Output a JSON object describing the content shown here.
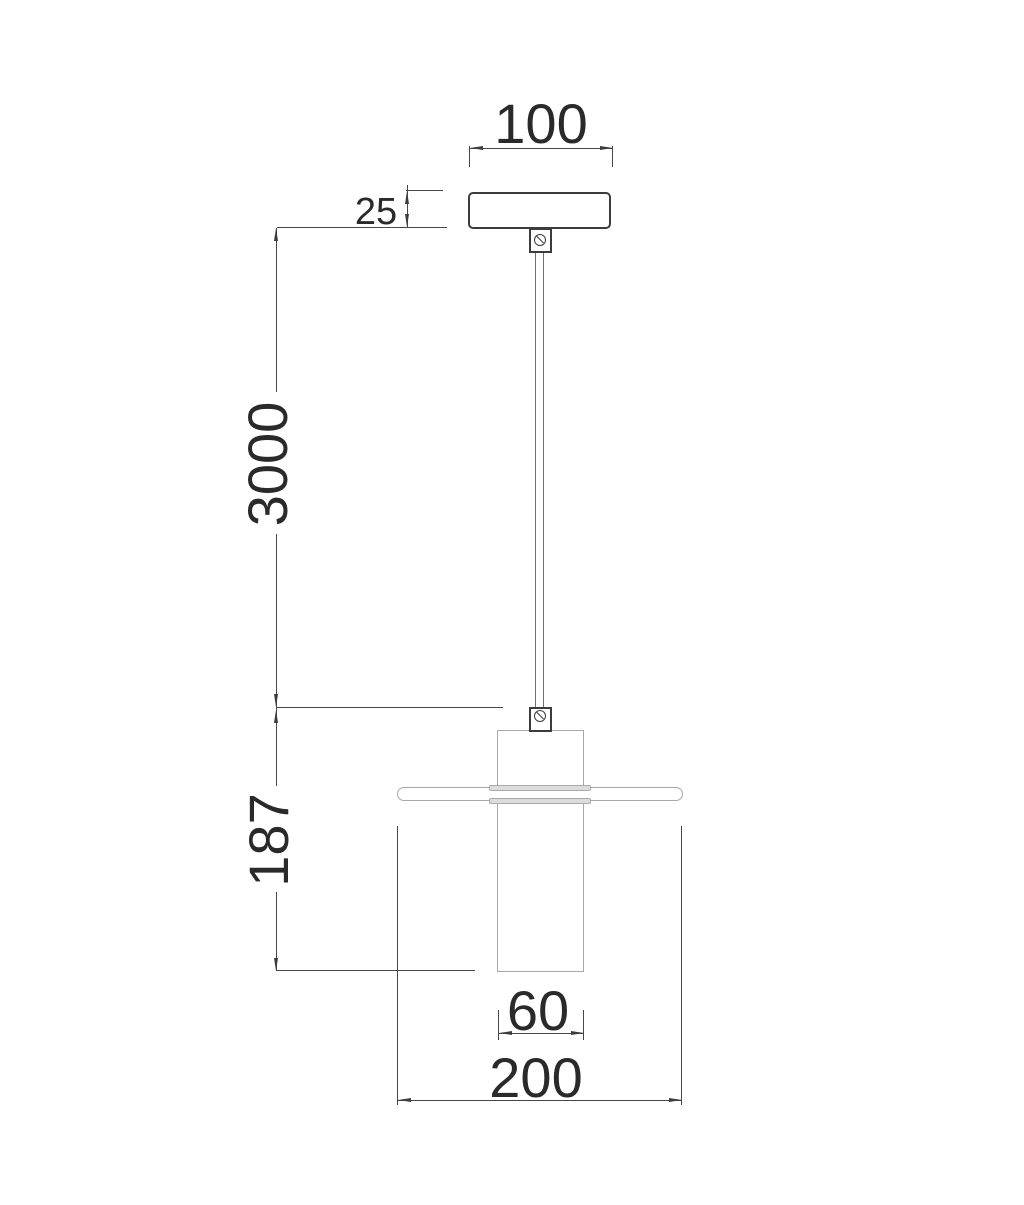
{
  "drawing": {
    "dimensions": {
      "canopy_width": "100",
      "canopy_height": "25",
      "suspension_length": "3000",
      "shade_height": "187",
      "inner_shade_diameter": "60",
      "shade_diameter": "200"
    },
    "colors": {
      "dimension_line": "#474747",
      "dimension_text": "#2a2a2a",
      "fixture_dark_outline": "#3c3c3c",
      "fixture_gray_outline": "#a8a8a8",
      "clamp_fill": "#dcdcdc",
      "background": "#ffffff"
    }
  }
}
